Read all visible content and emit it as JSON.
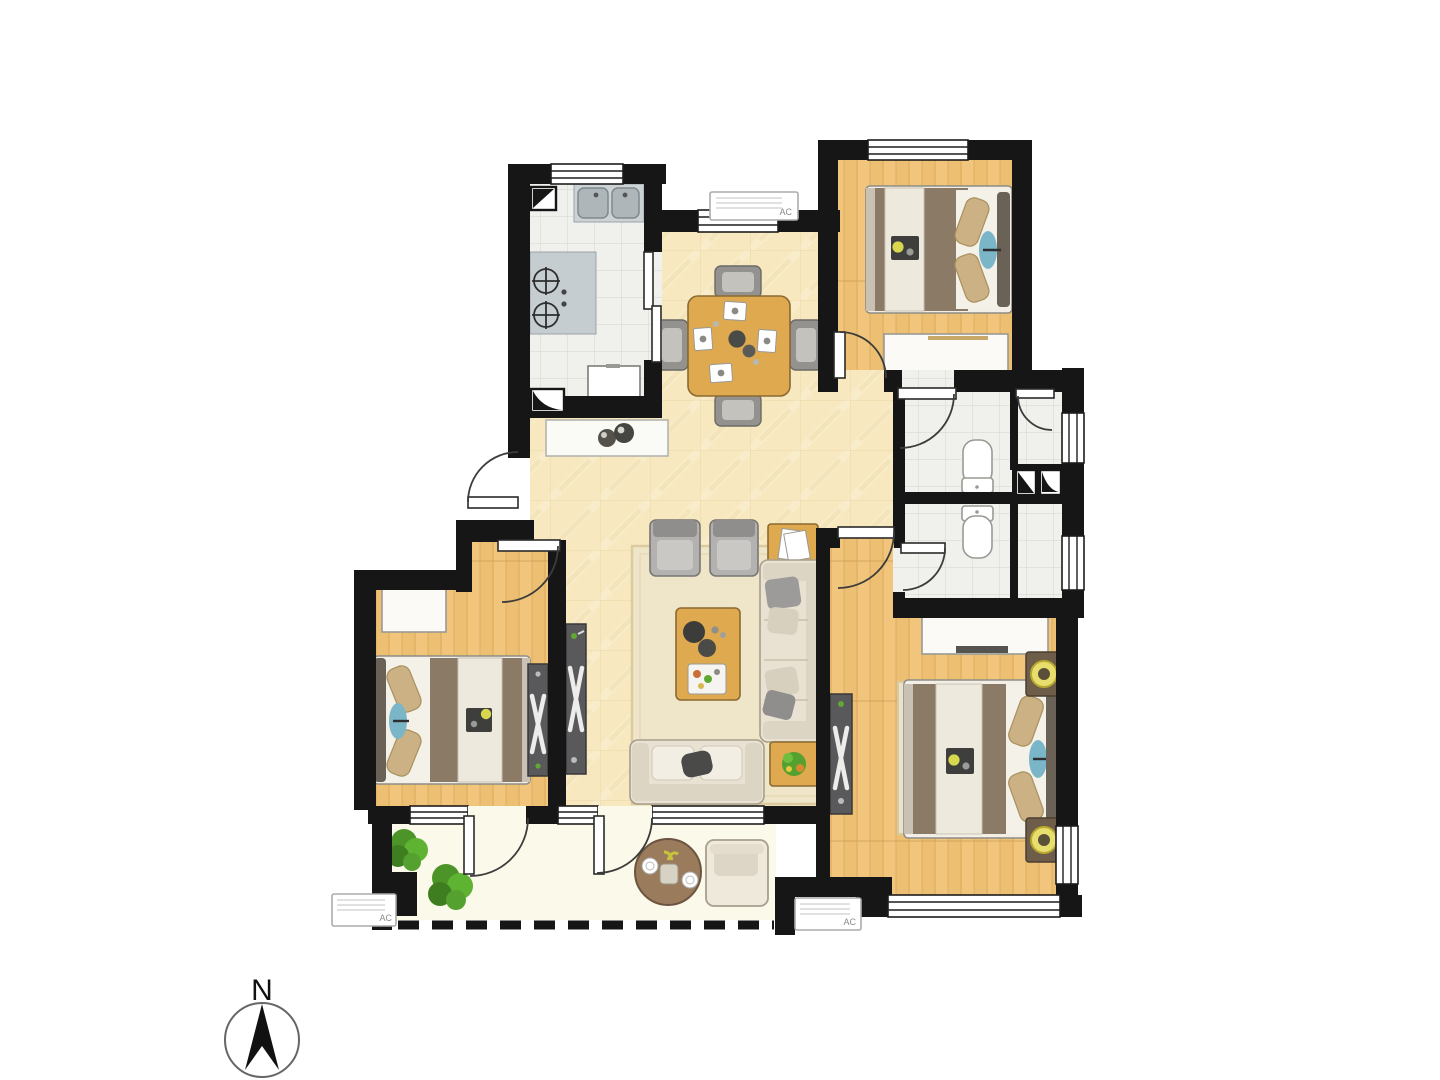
{
  "compass": {
    "label": "N"
  },
  "ac_units": {
    "label": "AC",
    "count": 3
  },
  "colors": {
    "wall": "#161616",
    "tile_warm_base": "#F7E8C0",
    "tile_warm_line": "#E6D09A",
    "wood_base": "#F1C67C",
    "wood_line": "#D9A75C",
    "tile_cool_base": "#F0F0ED",
    "tile_cool_line": "#DBDBD5",
    "balcony": "#FBF9E9",
    "rug": "#EFE5C9",
    "rug_border": "#DCCB9F",
    "sofa": "#E9E2D3",
    "furniture_wood": "#DFA94F",
    "dark_cabinet": "#59595B",
    "blanket": "#8A7A66",
    "pillow": "#CBB184",
    "accent_blue": "#7AB6C8",
    "plant_green": "#55A12F",
    "plant_green_dark": "#3E7E20",
    "lamp_yellow": "#E8DE6E",
    "balcony_table": "#9A7B5C"
  }
}
